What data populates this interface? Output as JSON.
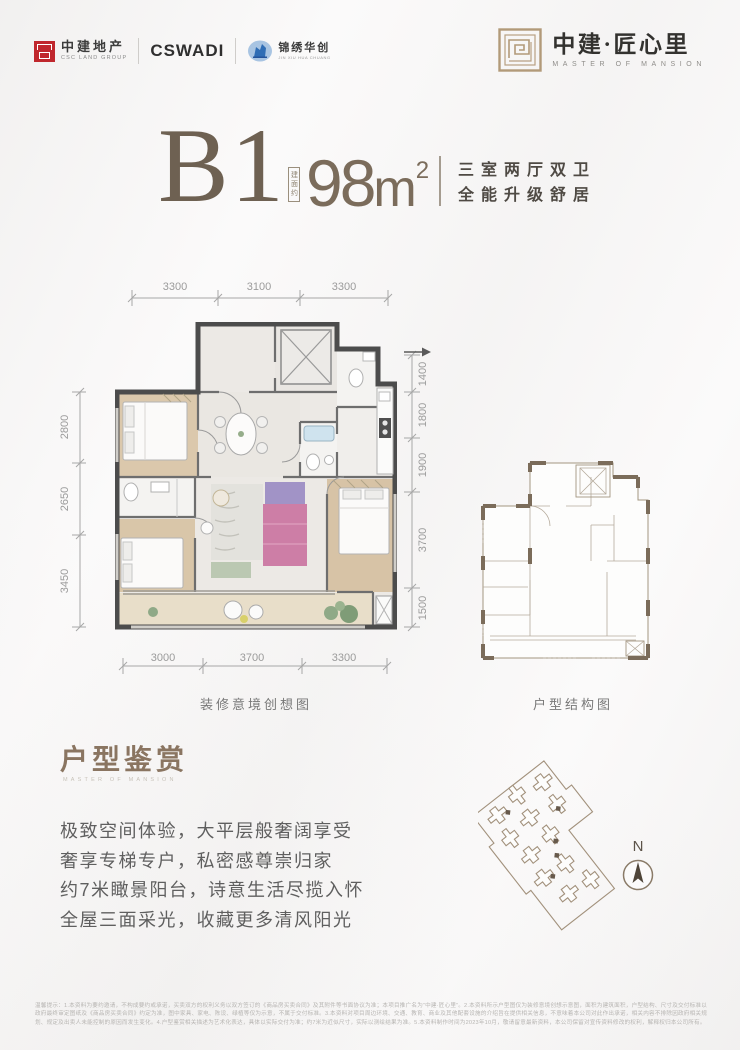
{
  "header": {
    "csc": {
      "name": "中建地产",
      "sub": "CSC LAND GROUP"
    },
    "cswadi": "CSWADI",
    "jinxiu": {
      "name": "锦绣华创",
      "sub": "JIN XIU HUA CHUANG"
    },
    "brand": {
      "name": "中建·匠心里",
      "sub": "MASTER OF MANSION"
    }
  },
  "title": {
    "unit": "B1",
    "area_label": "建面约",
    "area_value": "98",
    "area_unit": "m",
    "area_exp": "2",
    "desc_line1": "三室两厅双卫",
    "desc_line2": "全能升级舒居"
  },
  "floorplan": {
    "dims_top": [
      "3300",
      "3100",
      "3300"
    ],
    "dims_left": [
      "2800",
      "2650",
      "3450"
    ],
    "dims_right": [
      "1400",
      "1800",
      "1900",
      "3700",
      "1500"
    ],
    "dims_bottom": [
      "3000",
      "3700",
      "3300"
    ],
    "caption": "装修意境创想图"
  },
  "structure": {
    "caption": "户型结构图"
  },
  "appreciation": {
    "title": "户型鉴赏",
    "subtitle": "MASTER OF MANSION",
    "lines": [
      "极致空间体验，大平层般奢阔享受",
      "奢享专梯专户，私密感尊崇归家",
      "约7米瞰景阳台，诗意生活尽揽入怀",
      "全屋三面采光，收藏更多清风阳光"
    ]
  },
  "siteplan": {
    "compass": "N"
  },
  "disclaimer": "温馨提示：1.本资料为要约邀请，不构成要约或承诺，买卖双方的权利义务以双方签订的《商品房买卖合同》及其附件等书面协议为准；本项目推广名为“中建·匠心里”。2.本资料所示户型图仅为装修意境创想示意图，面积为建筑面积，户型结构、尺寸及交付标准以政府最终审定图纸及《商品房买卖合同》约定为准，图中家具、家电、陈设、绿植等仅为示意，不属于交付标准。3.本资料对项目周边环境、交通、教育、商业及其他配套设施的介绍旨在提供相关信息，不意味着本公司对此作出承诺，相关内容不排除因政府相关规划、规定及出卖人未能控制的原因而发生变化。4.户型鉴赏相关描述为艺术化表达，具体以实际交付为准；约7米为近似尺寸，实际以测绘结果为准。5.本资料制作时间为2023年10月，敬请留意最新资料，本公司保留对宣传资料修改的权利，解释权归本公司所有。",
  "colors": {
    "brand_brown": "#6e6152",
    "accent_tan": "#b29a79",
    "csc_red": "#c0272d",
    "jx_blue": "#2f6db5",
    "wall_dark": "#4c4c4c",
    "structure_brown": "#7b6c5a"
  }
}
